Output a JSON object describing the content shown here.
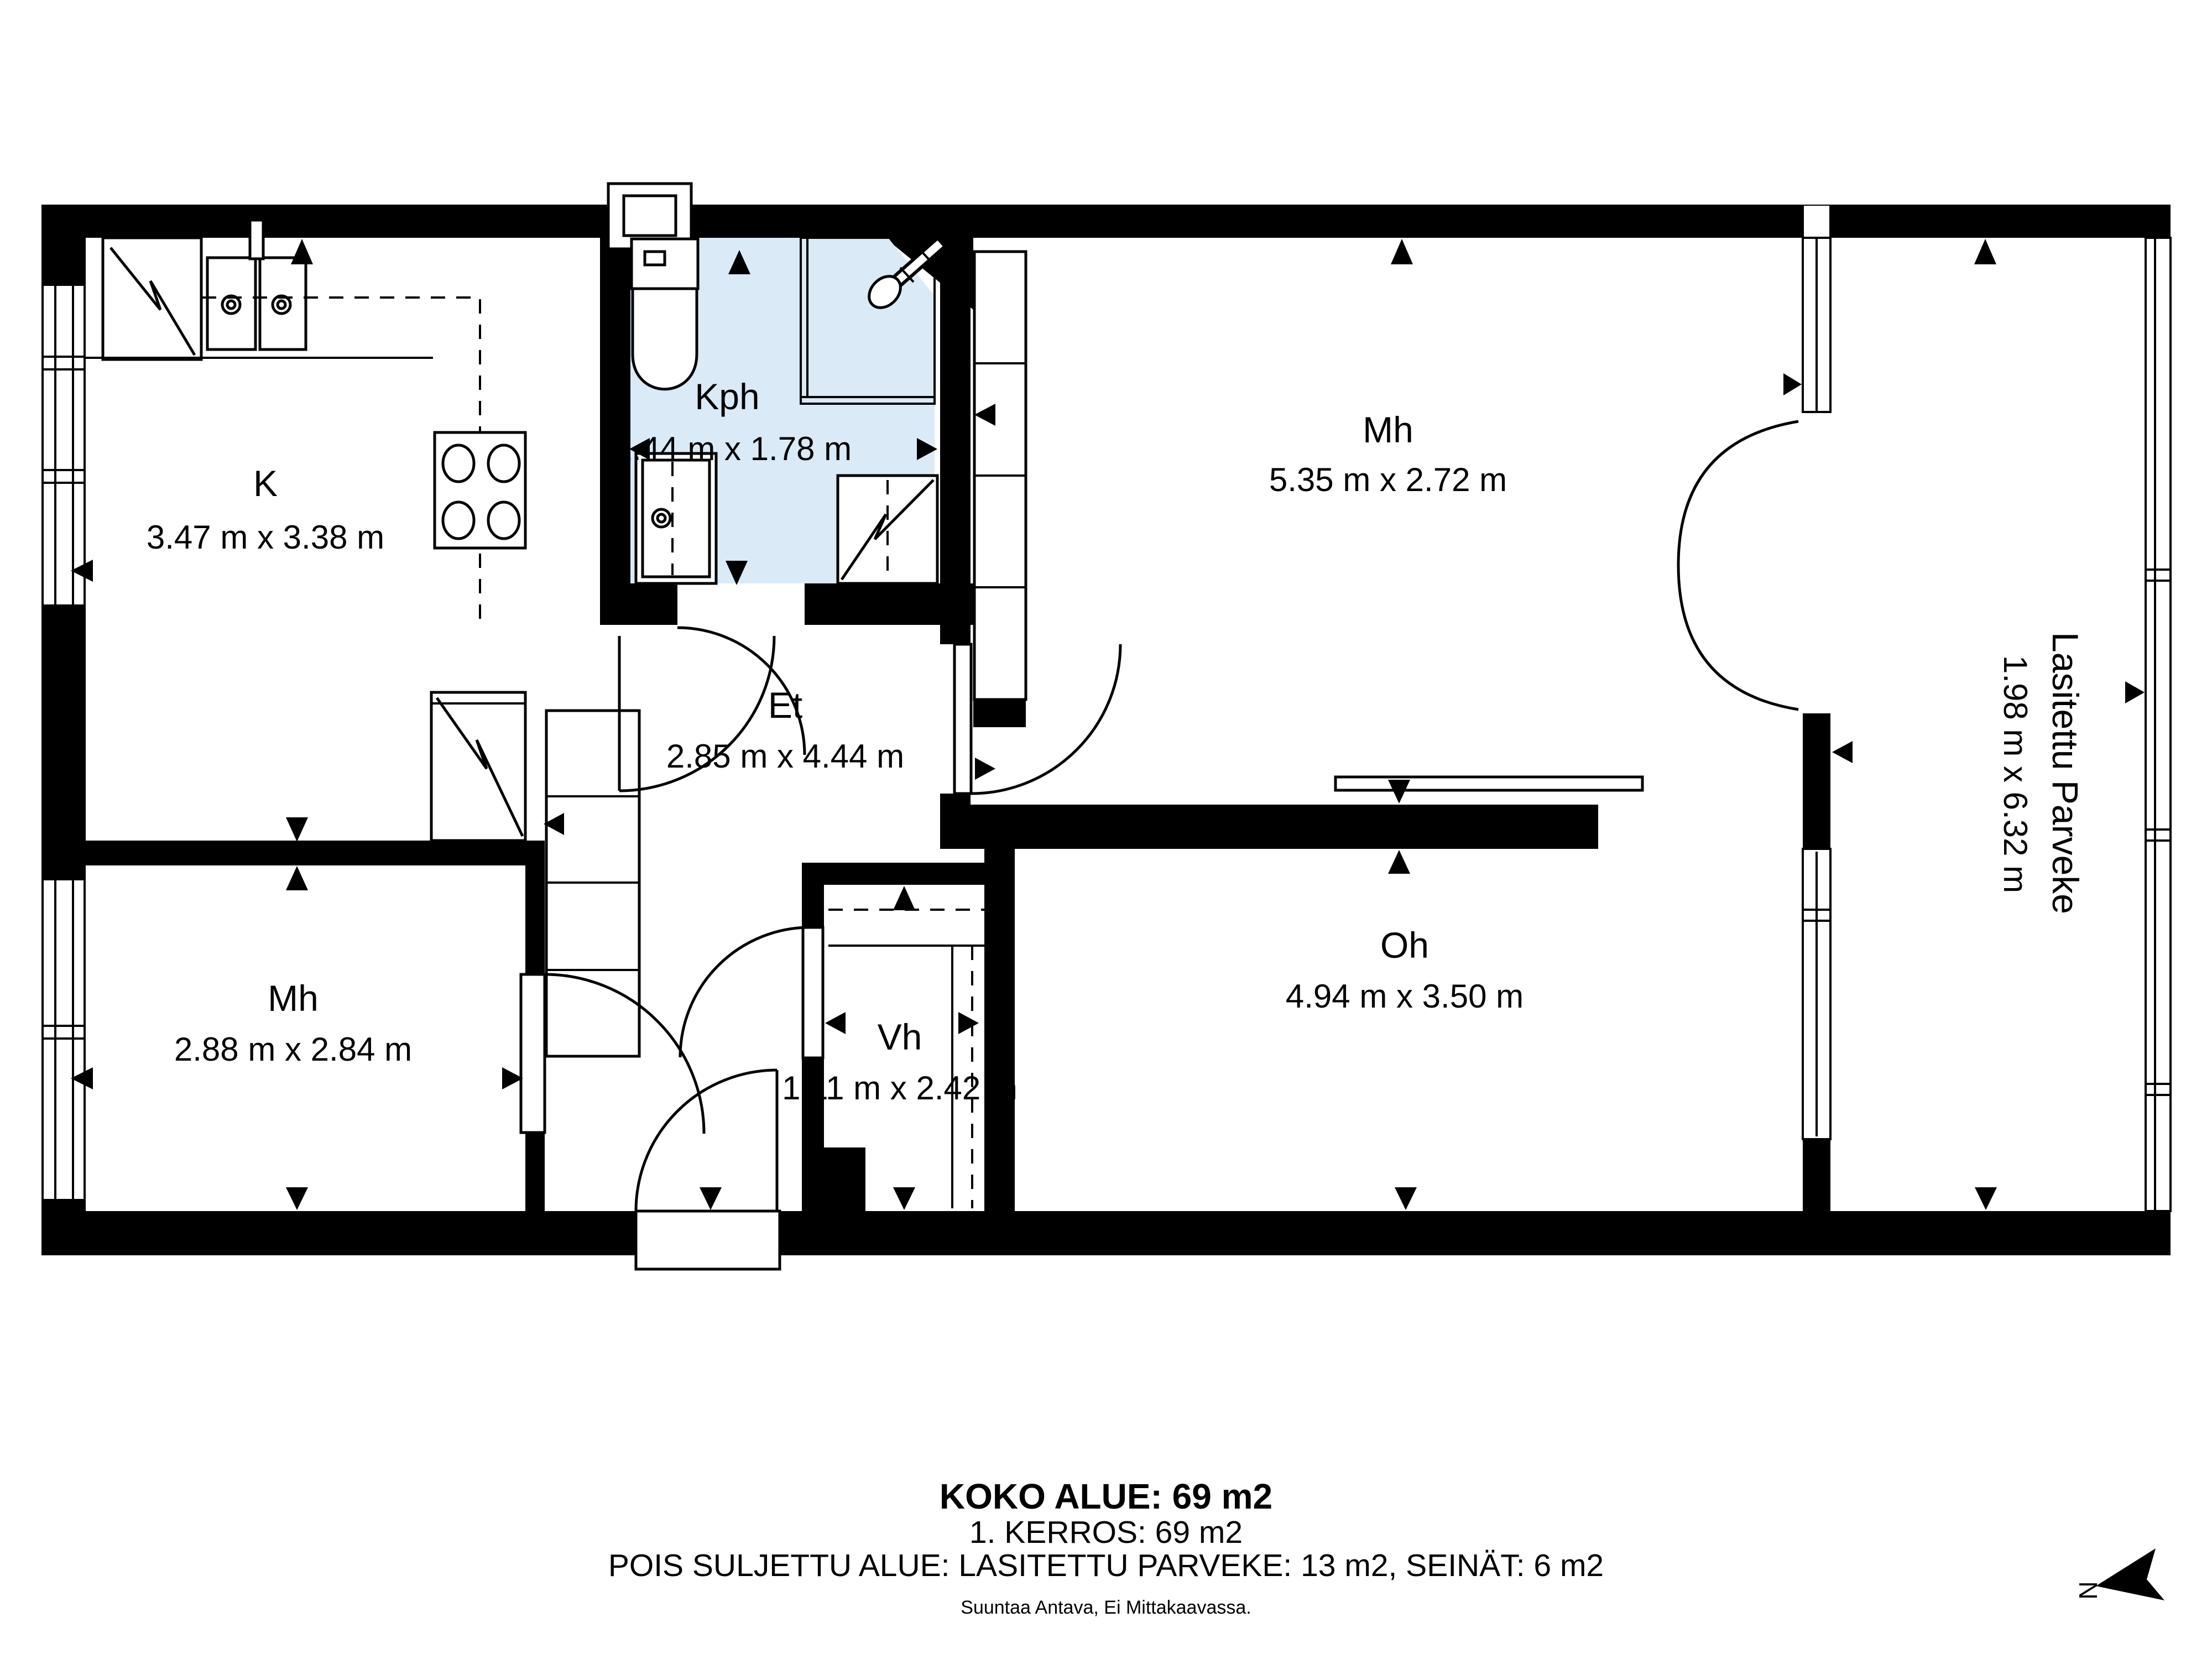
{
  "rooms": [
    {
      "name": "K",
      "dims": "3.47 m x 3.38 m"
    },
    {
      "name": "Kph",
      "dims": "2.44 m x 1.78 m"
    },
    {
      "name": "Mh",
      "dims": "5.35 m x 2.72 m"
    },
    {
      "name": "Lasitettu Parveke",
      "dims": "1.98 m x 6.32 m"
    },
    {
      "name": "Et",
      "dims": "2.85 m x 4.44 m"
    },
    {
      "name": "Mh",
      "dims": "2.88 m x 2.84 m"
    },
    {
      "name": "Vh",
      "dims": "1.11 m x 2.42 m"
    },
    {
      "name": "Oh",
      "dims": "4.94 m x 3.50 m"
    }
  ],
  "summary": {
    "total_area": "KOKO ALUE: 69 m2",
    "floor": "1. KERROS: 69 m2",
    "excluded": "POIS SULJETTU ALUE: LASITETTU PARVEKE: 13 m2, SEINÄT: 6 m2",
    "disclaimer": "Suuntaa Antava, Ei Mittakaavassa."
  },
  "compass": {
    "north_letter": "N"
  },
  "colors": {
    "wall": "#000000",
    "wet_room_fill": "#daeaf7",
    "background": "#ffffff"
  }
}
